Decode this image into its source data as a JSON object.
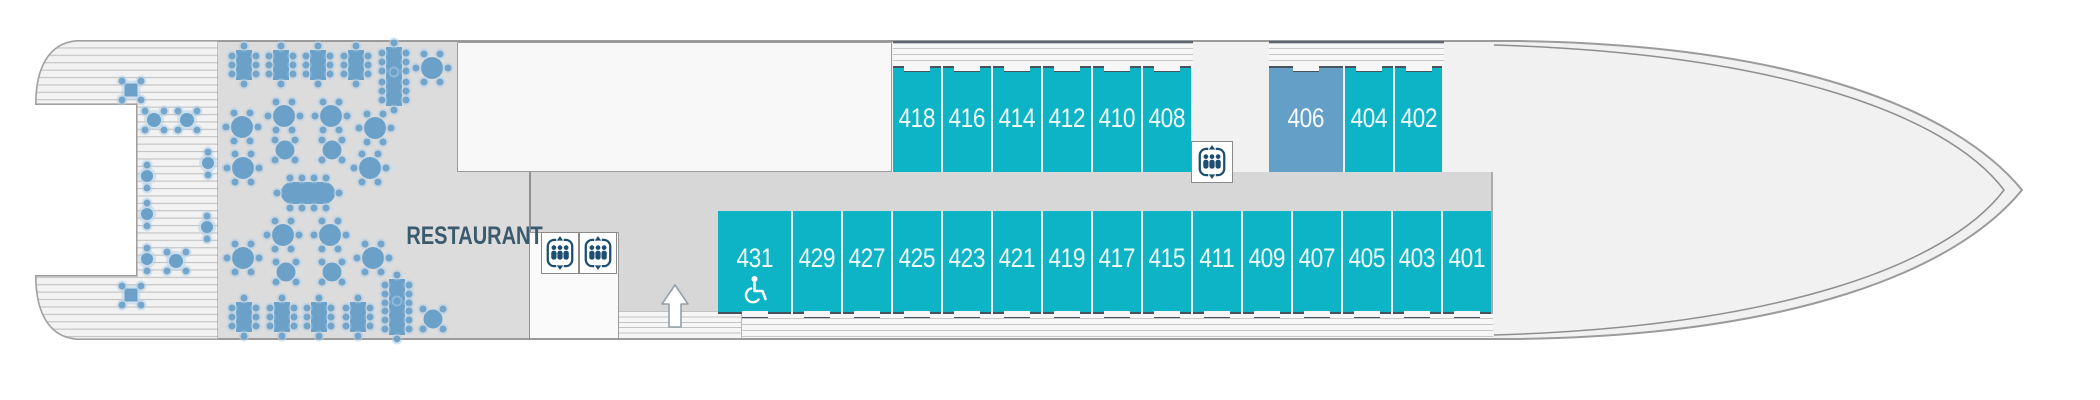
{
  "plan": {
    "title_hint": "ship-deck-plan",
    "restaurant": {
      "label": "RESTAURANT",
      "tables": [
        {
          "type": "rect8",
          "x": 244,
          "y": 65
        },
        {
          "type": "rect8",
          "x": 281,
          "y": 65
        },
        {
          "type": "rect8",
          "x": 318,
          "y": 65
        },
        {
          "type": "rect8",
          "x": 356,
          "y": 65
        },
        {
          "type": "rect8",
          "x": 394,
          "y": 62
        },
        {
          "type": "rect8",
          "x": 394,
          "y": 91
        },
        {
          "type": "round6",
          "x": 432,
          "y": 68
        },
        {
          "type": "round6",
          "x": 242,
          "y": 127
        },
        {
          "type": "round6",
          "x": 284,
          "y": 116
        },
        {
          "type": "round6",
          "x": 331,
          "y": 116
        },
        {
          "type": "round6",
          "x": 375,
          "y": 128
        },
        {
          "type": "round4",
          "x": 285,
          "y": 150
        },
        {
          "type": "round4",
          "x": 332,
          "y": 150
        },
        {
          "type": "round6",
          "x": 243,
          "y": 168
        },
        {
          "type": "round6",
          "x": 370,
          "y": 168
        },
        {
          "type": "oval12",
          "x": 308,
          "y": 193
        },
        {
          "type": "round6",
          "x": 283,
          "y": 235
        },
        {
          "type": "round6",
          "x": 330,
          "y": 235
        },
        {
          "type": "round6",
          "x": 243,
          "y": 258
        },
        {
          "type": "round6",
          "x": 373,
          "y": 258
        },
        {
          "type": "round4",
          "x": 286,
          "y": 272
        },
        {
          "type": "round4",
          "x": 332,
          "y": 272
        },
        {
          "type": "rect8",
          "x": 244,
          "y": 317
        },
        {
          "type": "rect8",
          "x": 282,
          "y": 317
        },
        {
          "type": "rect8",
          "x": 319,
          "y": 317
        },
        {
          "type": "rect8",
          "x": 358,
          "y": 317
        },
        {
          "type": "rect8",
          "x": 397,
          "y": 294
        },
        {
          "type": "rect8",
          "x": 397,
          "y": 320
        },
        {
          "type": "round4",
          "x": 433,
          "y": 319
        }
      ]
    },
    "stern_deck": {
      "tables": [
        {
          "type": "sq4",
          "x": 131,
          "y": 90
        },
        {
          "type": "sq4",
          "x": 131,
          "y": 295
        },
        {
          "type": "round4d",
          "x": 154,
          "y": 120
        },
        {
          "type": "round4d",
          "x": 187,
          "y": 120
        },
        {
          "type": "round4d",
          "x": 176,
          "y": 261
        },
        {
          "type": "round2v",
          "x": 147,
          "y": 176
        },
        {
          "type": "round2v",
          "x": 208,
          "y": 163
        },
        {
          "type": "round2v",
          "x": 147,
          "y": 214
        },
        {
          "type": "round2v",
          "x": 207,
          "y": 227
        },
        {
          "type": "round2v",
          "x": 147,
          "y": 259
        }
      ]
    },
    "cabins": {
      "top_row": [
        {
          "number": "418",
          "x": 893,
          "w": 50
        },
        {
          "number": "416",
          "x": 943,
          "w": 50
        },
        {
          "number": "414",
          "x": 993,
          "w": 50
        },
        {
          "number": "412",
          "x": 1043,
          "w": 50
        },
        {
          "number": "410",
          "x": 1093,
          "w": 50
        },
        {
          "number": "408",
          "x": 1143,
          "w": 50
        },
        {
          "number": "406",
          "x": 1269,
          "w": 76,
          "variant": "premium"
        },
        {
          "number": "404",
          "x": 1345,
          "w": 50
        },
        {
          "number": "402",
          "x": 1395,
          "w": 49
        }
      ],
      "bottom_row": [
        {
          "number": "431",
          "x": 718,
          "w": 75,
          "accessible": true
        },
        {
          "number": "429",
          "x": 793,
          "w": 50
        },
        {
          "number": "427",
          "x": 843,
          "w": 50
        },
        {
          "number": "425",
          "x": 893,
          "w": 50
        },
        {
          "number": "423",
          "x": 943,
          "w": 50
        },
        {
          "number": "421",
          "x": 993,
          "w": 50
        },
        {
          "number": "419",
          "x": 1043,
          "w": 50
        },
        {
          "number": "417",
          "x": 1093,
          "w": 50
        },
        {
          "number": "415",
          "x": 1143,
          "w": 50
        },
        {
          "number": "411",
          "x": 1193,
          "w": 50
        },
        {
          "number": "409",
          "x": 1243,
          "w": 50
        },
        {
          "number": "407",
          "x": 1293,
          "w": 50
        },
        {
          "number": "405",
          "x": 1343,
          "w": 50
        },
        {
          "number": "403",
          "x": 1393,
          "w": 50
        },
        {
          "number": "401",
          "x": 1443,
          "w": 50
        }
      ],
      "accessible_cabin": "431"
    },
    "icons": {
      "elevators": [
        {
          "x": 541,
          "y": 232,
          "w": 38,
          "h": 42
        },
        {
          "x": 579,
          "y": 232,
          "w": 38,
          "h": 42
        },
        {
          "x": 1191,
          "y": 141,
          "w": 42,
          "h": 42
        }
      ],
      "stairs_up_arrow": {
        "x": 661,
        "y": 284
      },
      "wheelchair_icon_in_cabin": "431"
    },
    "colors": {
      "cabin_teal": "#0db4c5",
      "cabin_premium_blue": "#639fc7",
      "cabin_border_dark": "#46525e",
      "corridor_gray": "#d7d7d7",
      "restaurant_floor": "#dcdcdc",
      "table_blue": "#6ba1c9",
      "icon_navy": "#1d4e70",
      "label_slate": "#3a5a6d",
      "hull_fill": "#f1f1f1",
      "hull_line": "#9b9b9b"
    }
  }
}
